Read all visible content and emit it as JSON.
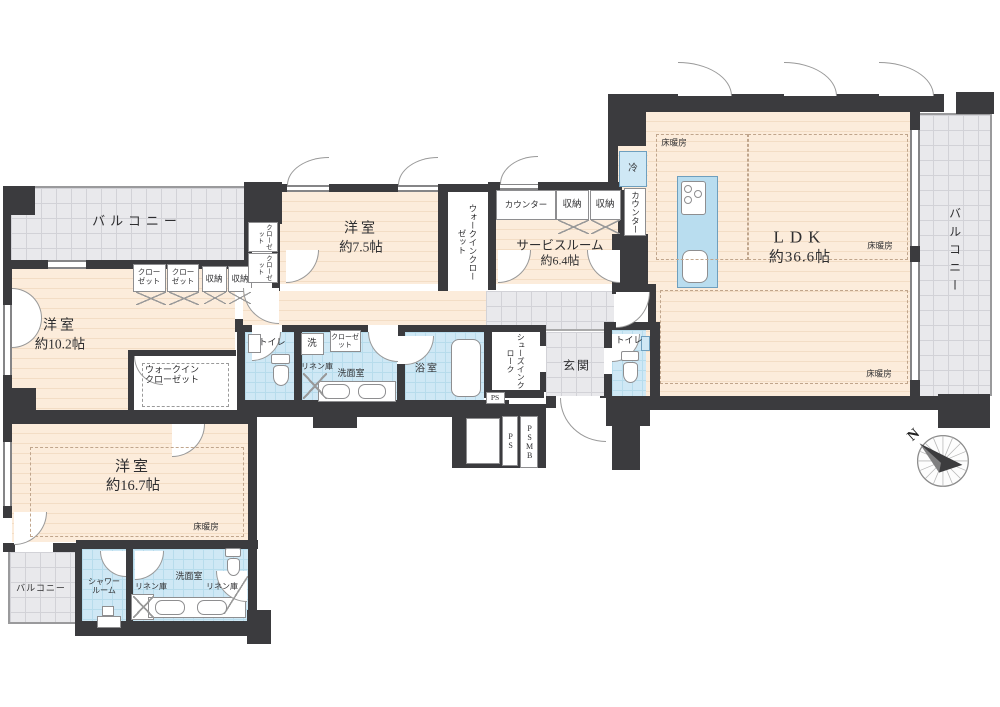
{
  "colors": {
    "wall": "#3b3b3e",
    "room_floor": "#fcecdb",
    "wet_area": "#cfe8f5",
    "balcony": "#e9e9ec",
    "kitchen_counter": "#b9ddef"
  },
  "rooms": {
    "ldk": {
      "name": "LDK",
      "size": "約36.6帖"
    },
    "bedroom_7_5": {
      "name": "洋室",
      "size": "約7.5帖"
    },
    "bedroom_10_2": {
      "name": "洋室",
      "size": "約10.2帖"
    },
    "bedroom_16_7": {
      "name": "洋室",
      "size": "約16.7帖"
    },
    "service_room": {
      "name": "サービスルーム",
      "size": "約6.4帖"
    }
  },
  "labels": {
    "balcony": "バルコニー",
    "entrance": "玄関",
    "toilet": "トイレ",
    "bath": "浴室",
    "washroom": "洗面室",
    "shower_room": "シャワールーム",
    "linen": "リネン庫",
    "walk_in_closet": "ウォークインクローゼット",
    "shoes_in_cloak": "シューズインクローク",
    "closet": "クローゼット",
    "counter": "カウンター",
    "storage": "収納",
    "fridge": "冷",
    "washer": "洗",
    "floor_heating": "床暖房",
    "ps": "PS",
    "psmb": "PSMB",
    "north": "N"
  }
}
